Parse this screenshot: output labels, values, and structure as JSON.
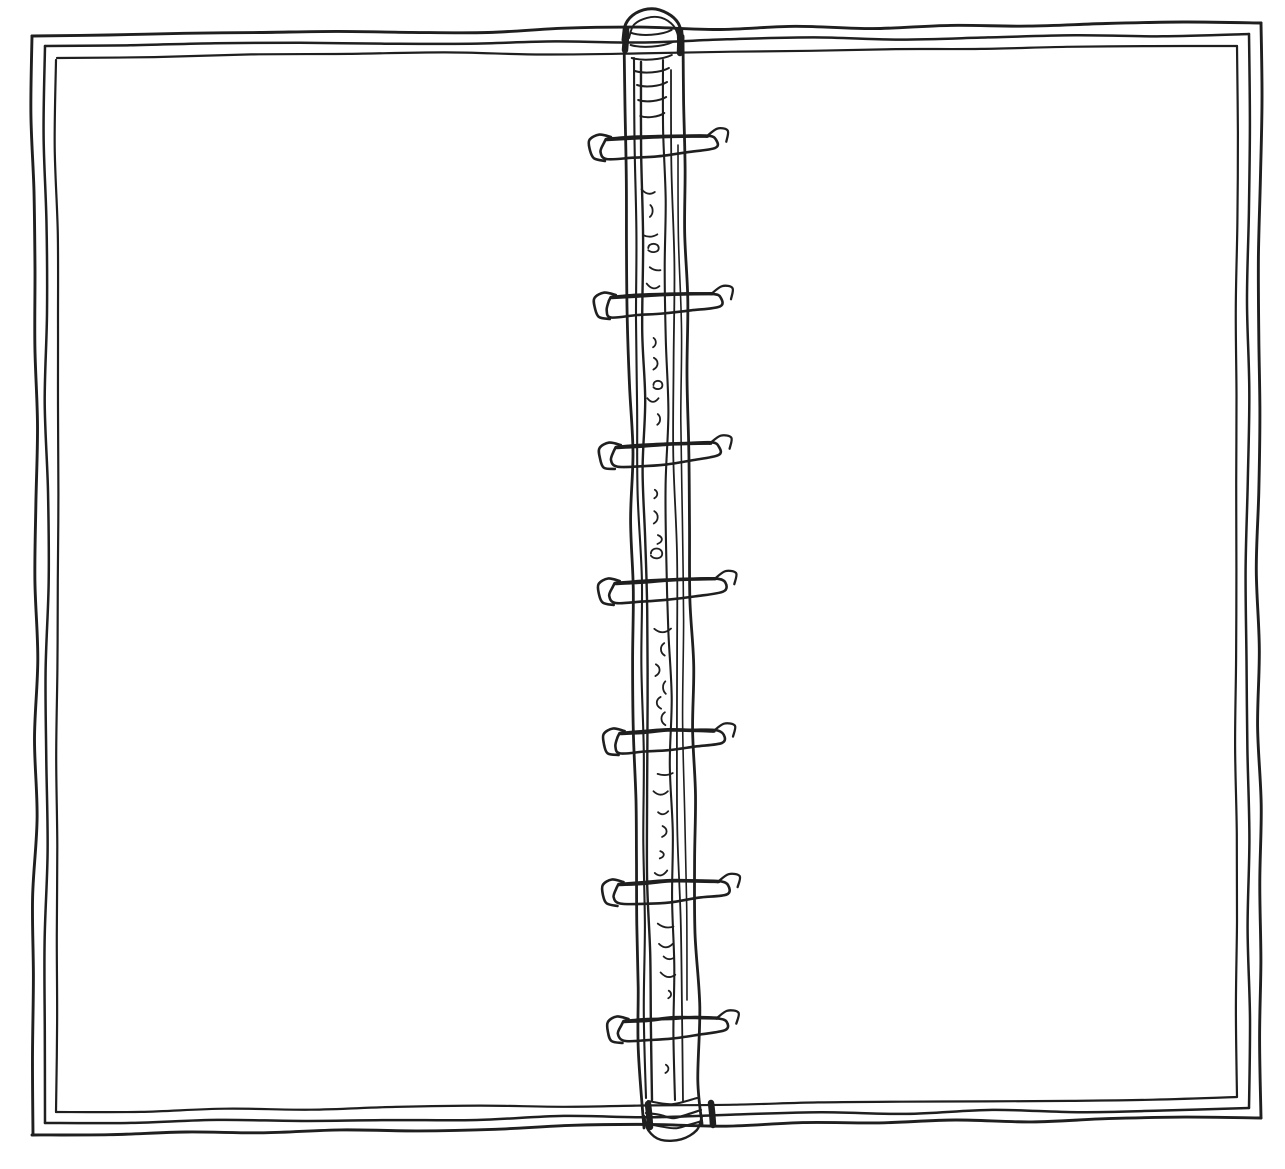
{
  "scene": {
    "description": "Hand-drawn black ink sketch of an open ring-binder notebook with blank pages",
    "background_color": "#ffffff",
    "ink_color": "#1f1f1f"
  },
  "notebook": {
    "left_page": {
      "content": ""
    },
    "right_page": {
      "content": ""
    },
    "binding": {
      "ring_count": 7,
      "ring_y_centers": [
        148,
        306,
        456,
        592,
        742,
        893,
        1030
      ]
    }
  }
}
